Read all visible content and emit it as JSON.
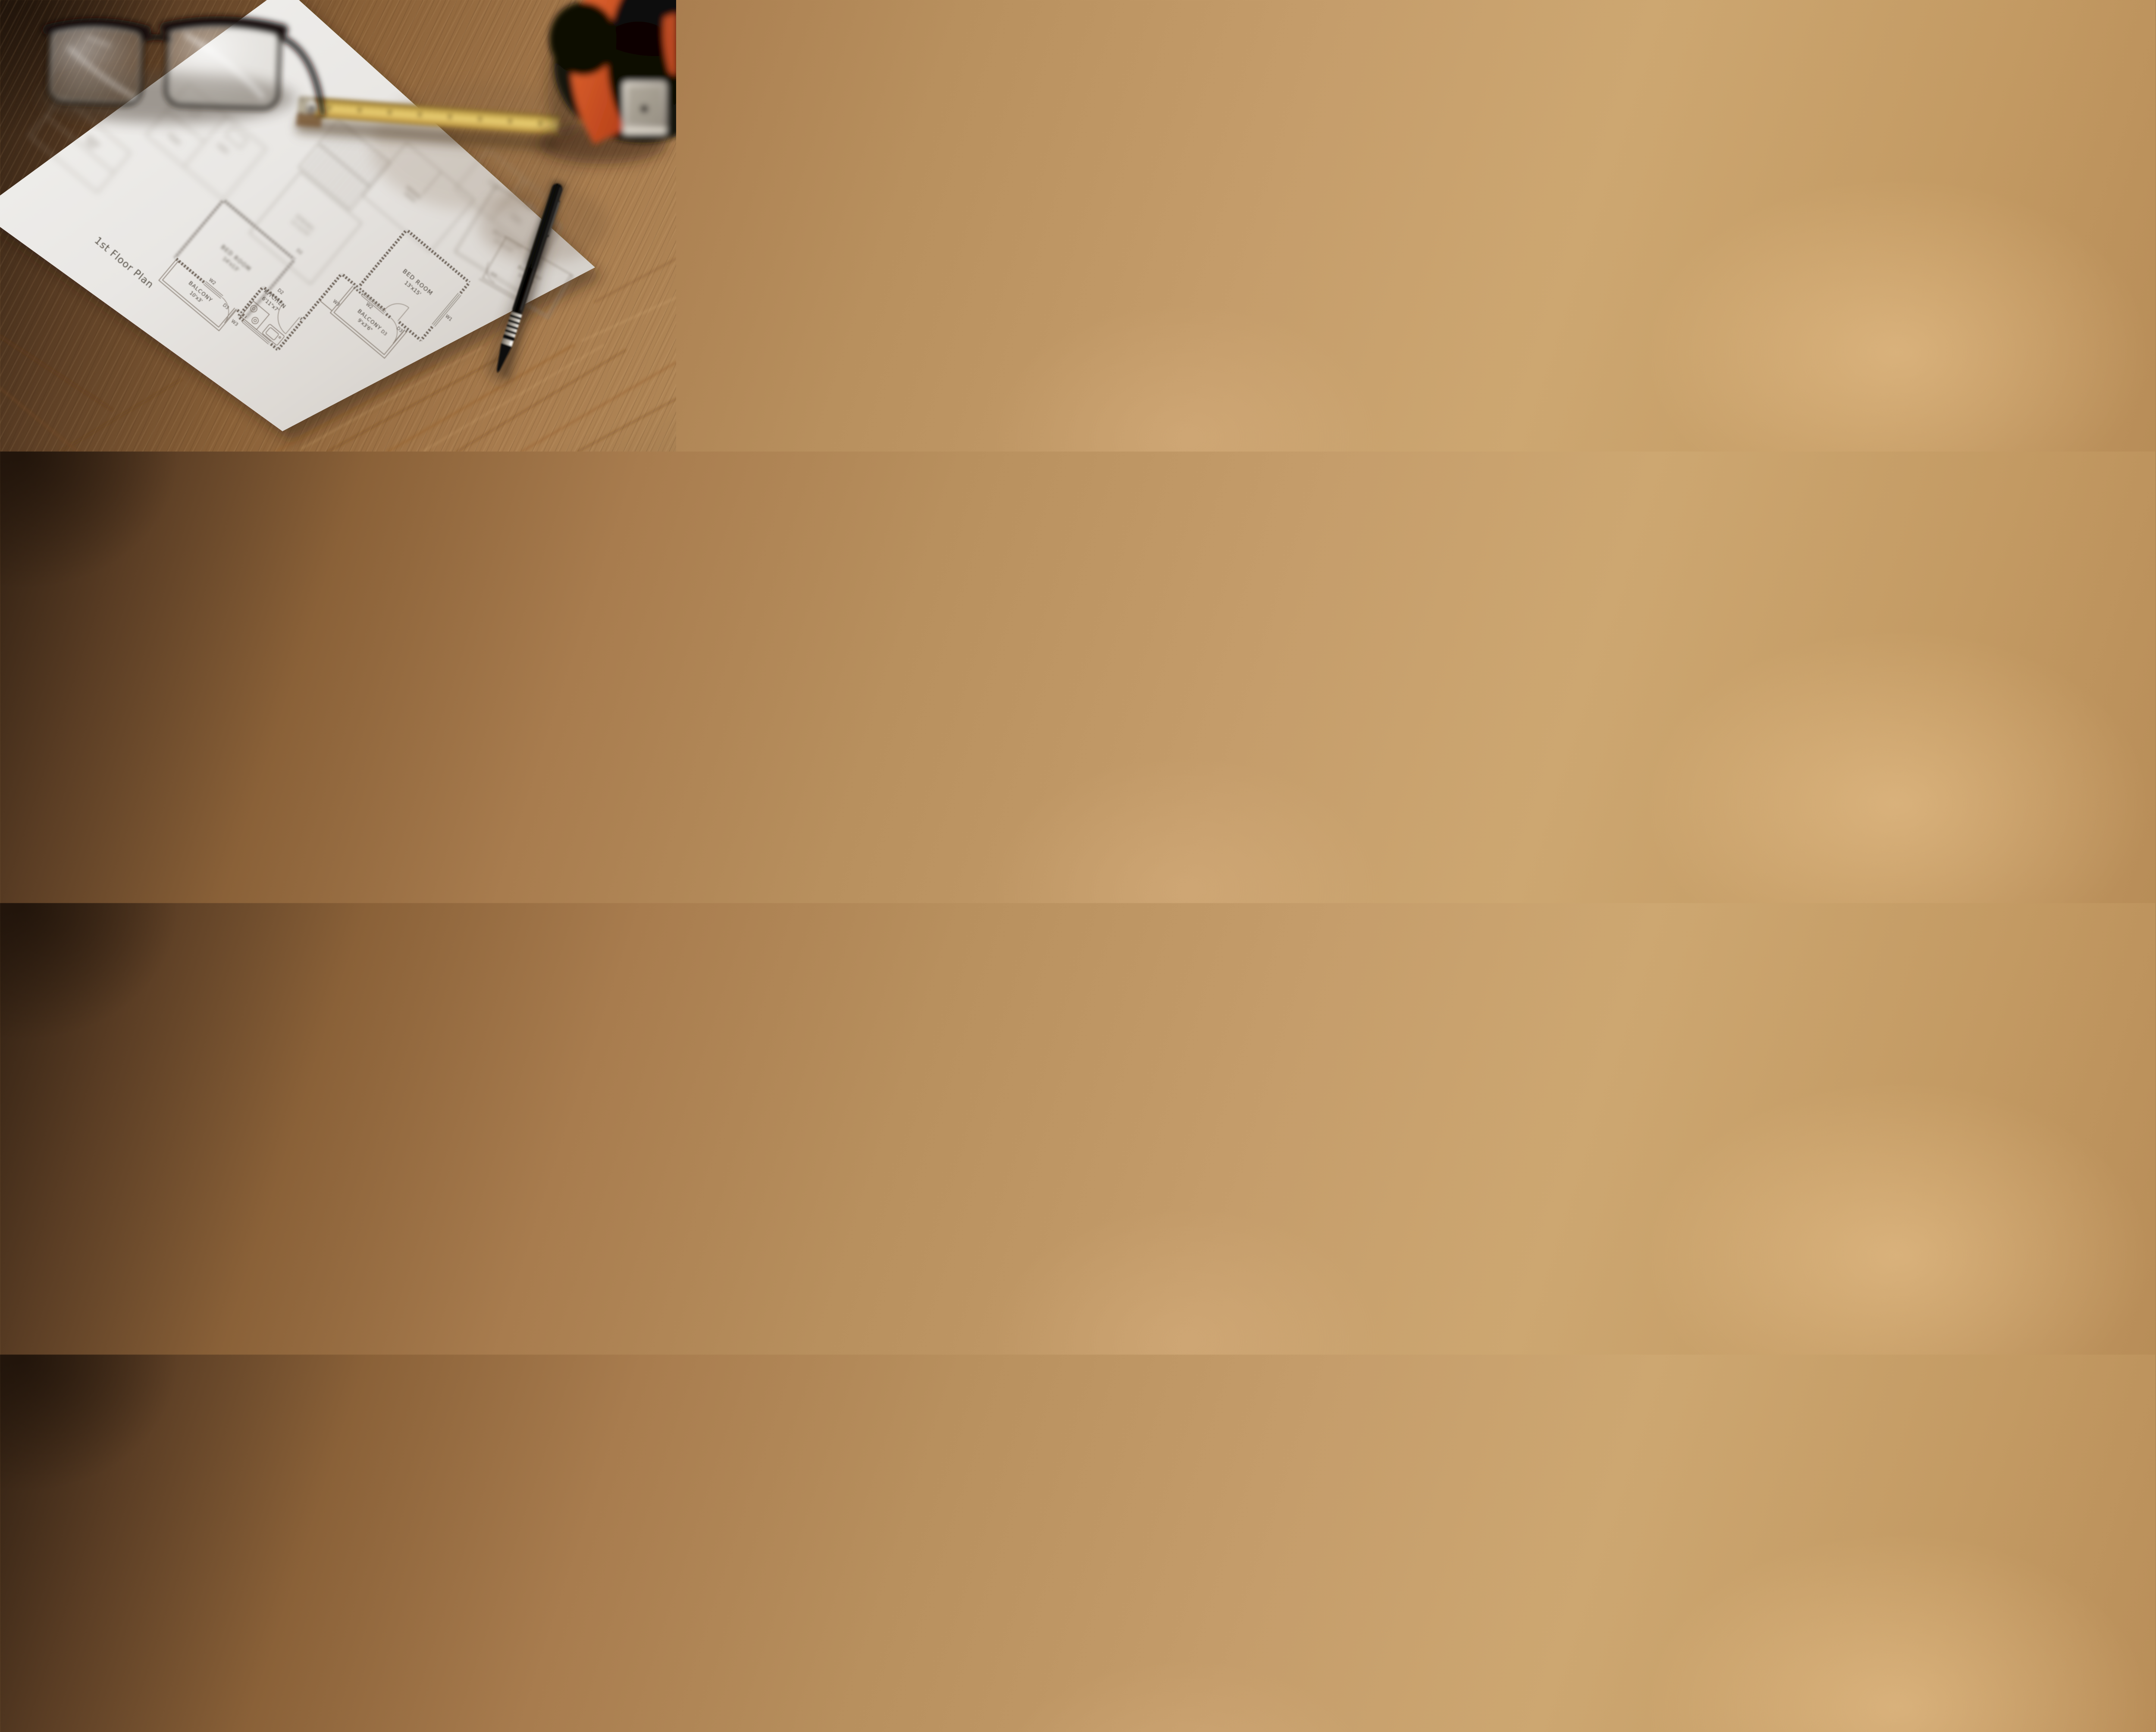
{
  "plan": {
    "title": "1st Floor Plan",
    "rooms": [
      {
        "name": "BED ROOM",
        "dims": "14'x13'"
      },
      {
        "name": "KITCHEN",
        "dims": "6'11\"x7'"
      },
      {
        "name": "BALCONY",
        "dims": "10'x3'"
      },
      {
        "name": "BED ROOM",
        "dims": "13'x15'"
      },
      {
        "name": "BALCONY",
        "dims": "9'x3'6\""
      },
      {
        "name": "DINING",
        "dims": "11'x12'6\""
      },
      {
        "name": "BED ROOM",
        "dims": "13'x11'6\""
      },
      {
        "name": "BALCONY",
        "dims": "10'x3'6\""
      }
    ],
    "markers": {
      "w1": "W1",
      "w2": "W2",
      "w3": "W3",
      "d2": "D2",
      "d3": "D3"
    }
  },
  "colors": {
    "wood": "#b8905e",
    "wood_dark": "#4a3120",
    "paper": "#e9e7e4",
    "ink": "#46403a",
    "tape_accent": "#d4512a",
    "ruler_yellow": "#dfc063",
    "pen_black": "#0c0a09",
    "metal": "#c9c3b8"
  }
}
